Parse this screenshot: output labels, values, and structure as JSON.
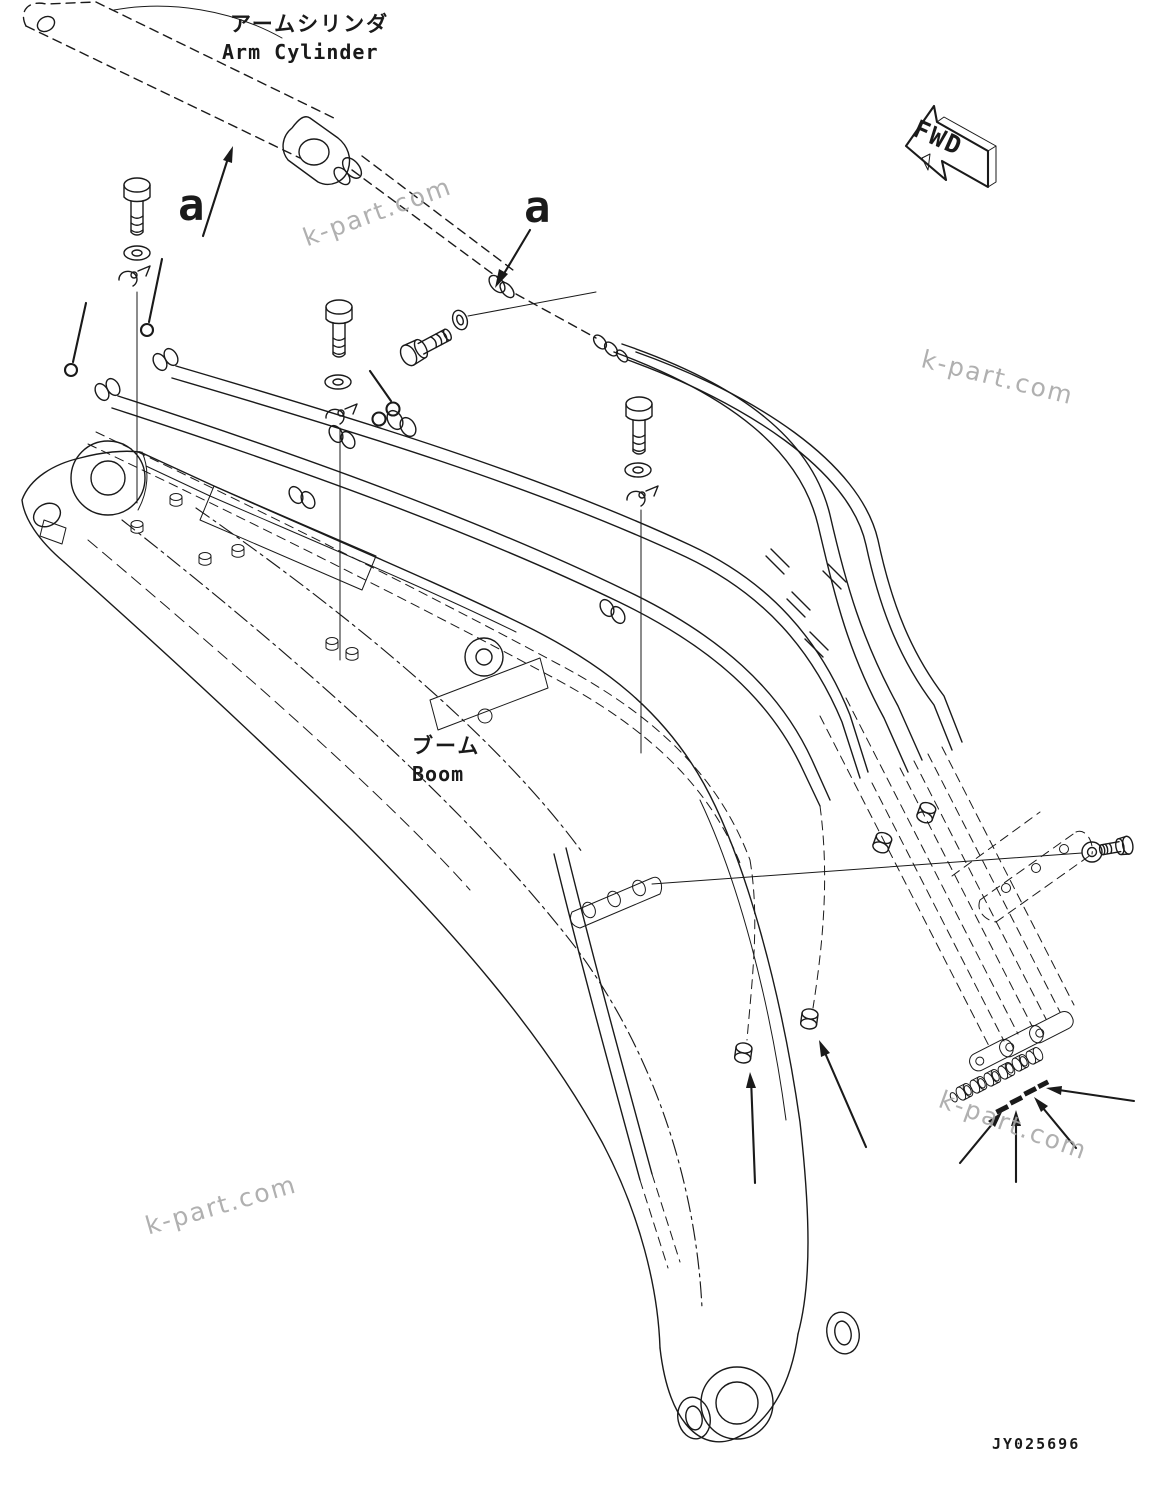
{
  "labels": {
    "arm_cylinder": {
      "jp": "アームシリンダ",
      "en": "Arm Cylinder"
    },
    "boom": {
      "jp": "ブーム",
      "en": "Boom"
    },
    "view_direction": "FWD",
    "detail_callout_left": "a",
    "detail_callout_right": "a",
    "drawing_number": "JY025696"
  },
  "watermark": {
    "text": "k-part.com"
  },
  "colors": {
    "line": "#1a1a1a",
    "watermark": "#a8a8a8",
    "background": "#ffffff"
  }
}
